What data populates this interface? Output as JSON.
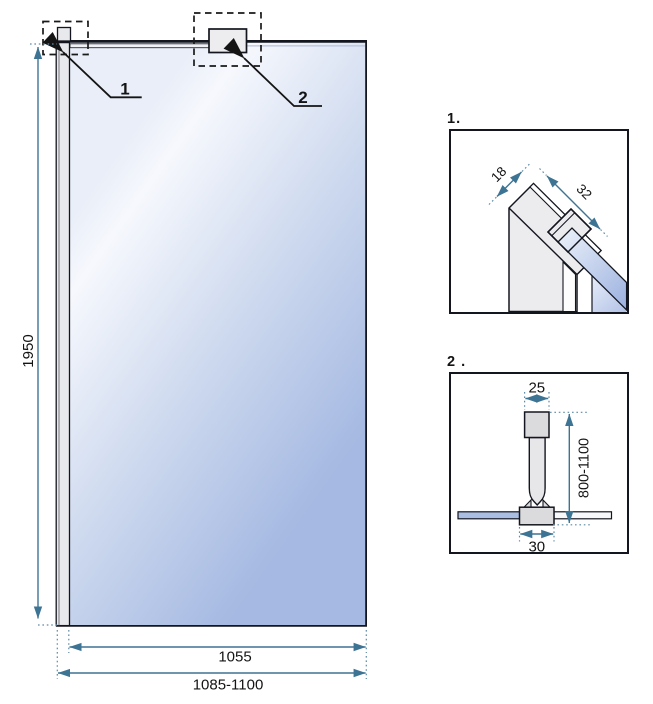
{
  "main_view": {
    "height_dim": "1950",
    "glass_width_dim": "1055",
    "total_width_dim": "1085-1100",
    "callout_1": "1",
    "callout_2": "2"
  },
  "detail_1": {
    "title": "1.",
    "depth_dim": "18",
    "width_dim": "32"
  },
  "detail_2": {
    "title": "2 .",
    "top_width_dim": "25",
    "length_dim": "800-1100",
    "clamp_width_dim": "30"
  },
  "colors": {
    "dimension_line": "#3d7494",
    "extension_dots": "#5d8aa6",
    "outline": "#141414",
    "glass_blue": "#a5b9e2",
    "glass_light": "#f6f8fd",
    "metal_gray": "#e9e9ec"
  }
}
